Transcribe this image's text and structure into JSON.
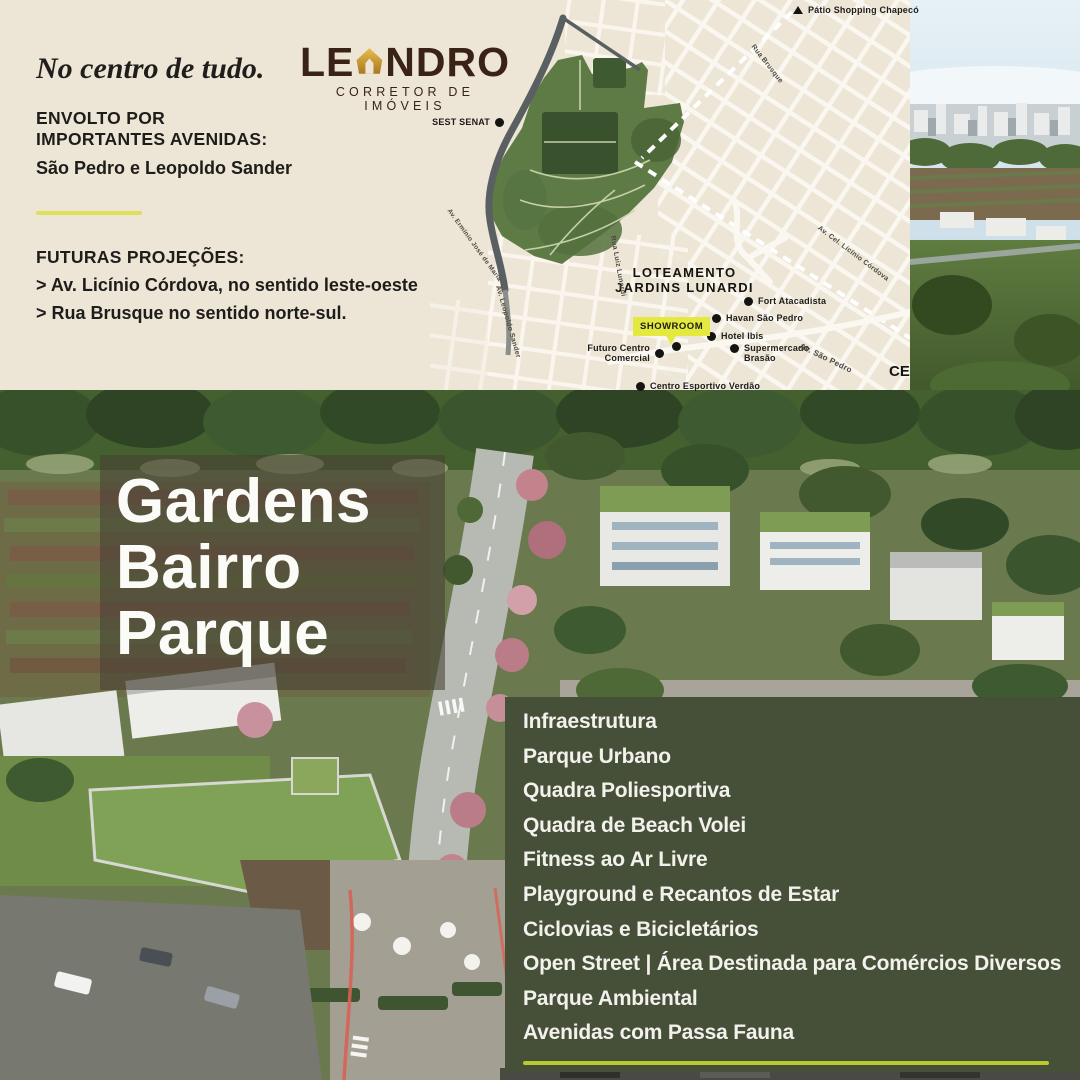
{
  "info_panel": {
    "tagline": "No centro de tudo.",
    "envolto_line1": "ENVOLTO POR",
    "envolto_line2": "IMPORTANTES AVENIDAS:",
    "avenues": "São Pedro e Leopoldo Sander",
    "futuras_title": "FUTURAS PROJEÇÕES:",
    "futuras_item1": "> Av. Licínio Córdova, no sentido leste-oeste",
    "futuras_item2": "> Rua Brusque no sentido norte-sul."
  },
  "logo": {
    "name_start": "LE",
    "name_end": "NDRO",
    "subtitle": "CORRETOR DE IMÓVEIS",
    "gold_color": "#D9A73C",
    "brown_color": "#3A2316"
  },
  "map": {
    "loteamento_line1": "LOTEAMENTO",
    "loteamento_line2": "JARDINS LUNARDI",
    "showroom": "SHOWROOM",
    "corner_label": "CE",
    "pois": [
      {
        "label": "SEST SENAT"
      },
      {
        "label": "Pátio Shopping Chapecó"
      },
      {
        "label": "Fort Atacadista"
      },
      {
        "label": "Havan São Pedro"
      },
      {
        "label": "Hotel Ibis"
      },
      {
        "label": "Supermercado Brasão"
      },
      {
        "label": "Futuro Centro Comercial"
      },
      {
        "label": "Centro Esportivo Verdão"
      }
    ],
    "streets": [
      {
        "label": "Rua Brusque"
      },
      {
        "label": "Av. Cel. Licínio Córdova"
      },
      {
        "label": "Av. São Pedro"
      },
      {
        "label": "Rua Luiz Lunardi"
      },
      {
        "label": "Av. Leopoldo Sander"
      },
      {
        "label": "Av. Ermínio José de Maria"
      }
    ]
  },
  "hero": {
    "line1": "Gardens",
    "line2": "Bairro",
    "line3": "Parque"
  },
  "amenities": {
    "items": [
      "Infraestrutura",
      "Parque Urbano",
      "Quadra Poliesportiva",
      "Quadra de Beach Volei",
      "Fitness ao Ar Livre",
      "Playground e Recantos de Estar",
      "Ciclovias e Bicicletários",
      "Open Street | Área Destinada para Comércios Diversos",
      "Parque Ambiental",
      "Avenidas com Passa Fauna"
    ]
  },
  "colors": {
    "cream": "#EDE6D7",
    "panel_green": "#465039",
    "accent_lime": "#B9C92E",
    "divider_yellow": "#DFE058",
    "showroom_yellow": "#E3E93F",
    "map_ink": "#1D1C1A"
  }
}
